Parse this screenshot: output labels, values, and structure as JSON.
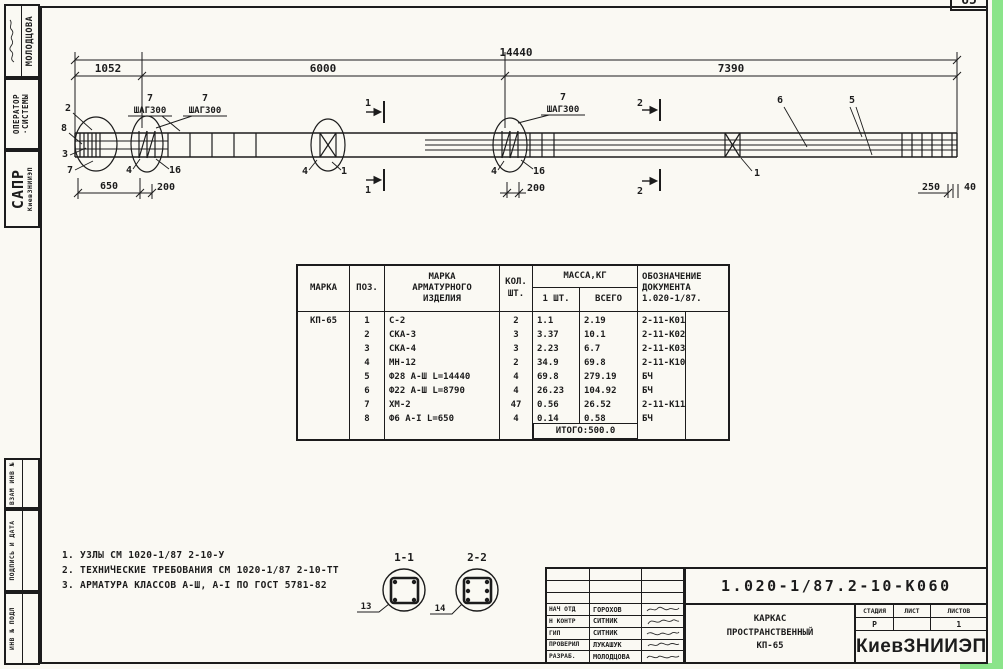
{
  "page": {
    "corner_number": "65"
  },
  "sidebar": {
    "author_name": "МОЛОДЦОВА",
    "operator_line1": "ОПЕРАТОР",
    "operator_line2": "·СИСТЕМЫ",
    "org_short": "САПР",
    "org_sub": "КиевЗНИИЭП",
    "stamp_vzam": "ВЗАМ ИНВ №",
    "stamp_podpis": "ПОДПИСЬ И ДАТА",
    "stamp_inv": "ИНВ № ПОДЛ"
  },
  "drawing": {
    "dims": {
      "overall": "14440",
      "seg1": "1052",
      "seg2": "6000",
      "seg3": "7390",
      "left_len": "650",
      "left_step": "200",
      "mid_step": "200",
      "right_len": "250",
      "right_gap": "40"
    },
    "callout_pos": "7",
    "callout_step": "ШАГ300",
    "pos_labels": {
      "p1": "1",
      "p2": "2",
      "p3": "3",
      "p4": "4",
      "p5": "5",
      "p6": "6",
      "p7": "7",
      "p8": "8",
      "p16": "16"
    },
    "sections": {
      "a_title": "1-1",
      "b_title": "2-2",
      "a_ref": "13",
      "b_ref": "14"
    }
  },
  "notes": {
    "line1": "1. УЗЛЫ СМ 1020-1/87 2-10-У",
    "line2": "2. ТЕХНИЧЕСКИЕ ТРЕБОВАНИЯ СМ 1020-1/87 2-10-ТТ",
    "line3": "3. АРМАТУРА КЛАССОВ А-Ш, А-I ПО ГОСТ 5781-82"
  },
  "table": {
    "h_marka": "МАРКА",
    "h_poz": "ПОЗ.",
    "h_item1": "МАРКА",
    "h_item2": "АРМАТУРНОГО",
    "h_item3": "ИЗДЕЛИЯ",
    "h_qty1": "КОЛ.",
    "h_qty2": "ШТ.",
    "h_mass": "МАССА,КГ",
    "h_mass1": "1 ШТ.",
    "h_massall": "ВСЕГО",
    "h_doc1": "ОБОЗНАЧЕНИЕ",
    "h_doc2": "ДОКУМЕНТА",
    "h_doc3": "1.020-1/87.",
    "marka": "КП-65",
    "rows": [
      {
        "pos": "1",
        "item": "С-2",
        "qty": "2",
        "mass1": "1.1",
        "massall": "2.19",
        "doc": "2-11-К01"
      },
      {
        "pos": "2",
        "item": "СКА-3",
        "qty": "3",
        "mass1": "3.37",
        "massall": "10.1",
        "doc": "2-11-К02"
      },
      {
        "pos": "3",
        "item": "СКА-4",
        "qty": "3",
        "mass1": "2.23",
        "massall": "6.7",
        "doc": "2-11-К03"
      },
      {
        "pos": "4",
        "item": "МН-12",
        "qty": "2",
        "mass1": "34.9",
        "massall": "69.8",
        "doc": "2-11-К10"
      },
      {
        "pos": "5",
        "item": "Ф28 А-Ш L=14440",
        "qty": "4",
        "mass1": "69.8",
        "massall": "279.19",
        "doc": "БЧ"
      },
      {
        "pos": "6",
        "item": "Ф22 А-Ш L=8790",
        "qty": "4",
        "mass1": "26.23",
        "massall": "104.92",
        "doc": "БЧ"
      },
      {
        "pos": "7",
        "item": "ХМ-2",
        "qty": "47",
        "mass1": "0.56",
        "massall": "26.52",
        "doc": "2-11-К11"
      },
      {
        "pos": "8",
        "item": "Ф6 А-I L=650",
        "qty": "4",
        "mass1": "0.14",
        "massall": "0.58",
        "doc": "БЧ"
      }
    ],
    "total": "ИТОГО:500.0"
  },
  "titleblock": {
    "doc_number": "1.020-1/87.2-10-К060",
    "title1": "КАРКАС",
    "title2": "ПРОСТРАНСТВЕННЫЙ",
    "title3": "КП-65",
    "stage_label": "СТАДИЯ",
    "sheet_label": "ЛИСТ",
    "sheets_label": "ЛИСТОВ",
    "stage": "Р",
    "sheet": "",
    "sheets": "1",
    "org": "КиевЗНИИЭП",
    "people": [
      {
        "role": "НАЧ ОТД",
        "name": "ГОРОХОВ"
      },
      {
        "role": "Н КОНТР",
        "name": "СИТНИК"
      },
      {
        "role": "ГИП",
        "name": "СИТНИК"
      },
      {
        "role": "ПРОВЕРИЛ",
        "name": "ЛУКАШУК"
      },
      {
        "role": "РАЗРАБ.",
        "name": "МОЛОДЦОВА"
      }
    ]
  },
  "colors": {
    "paper": "#faf9f3",
    "ink": "#1c1c1c",
    "scan_green": "#8be48a"
  }
}
